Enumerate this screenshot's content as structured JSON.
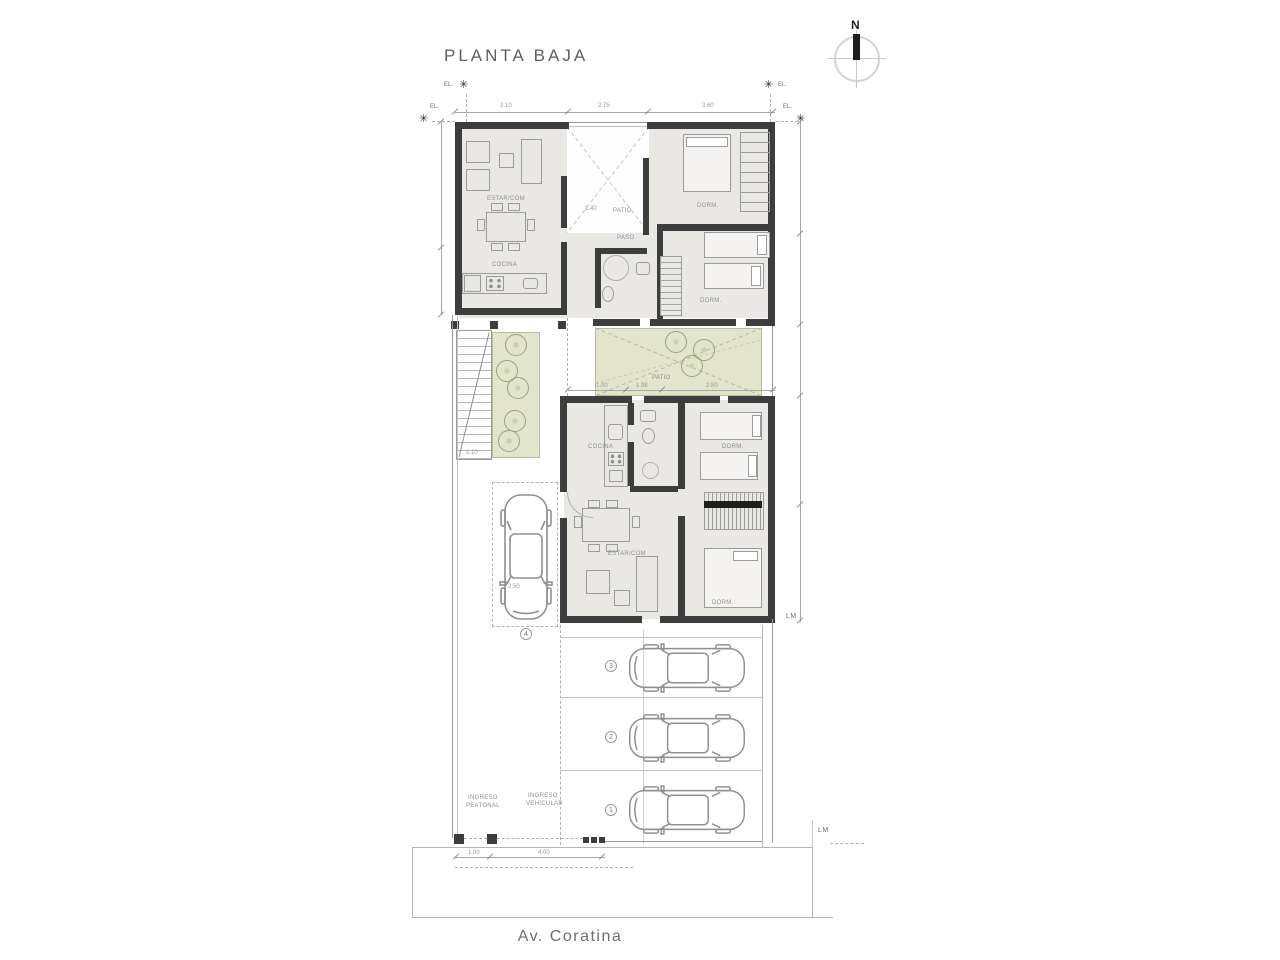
{
  "title": "PLANTA BAJA",
  "compass": {
    "n": "N"
  },
  "street": {
    "name": "Av. Coratina"
  },
  "markers": {
    "el": "EL.",
    "lm": "LM"
  },
  "upper_unit": {
    "estar": "ESTAR/COM",
    "cocina": "COCINA",
    "patio": "PATIO",
    "paso": "PASO",
    "dorm_a": "DORM.",
    "dorm_b": "DORM."
  },
  "lower_unit": {
    "estar": "ESTAR/COM",
    "cocina": "COCINA",
    "dorm_a": "DORM.",
    "dorm_b": "DORM."
  },
  "site": {
    "patio": "PATIO",
    "ingreso_peatonal": [
      "INGRESO",
      "PEATONAL"
    ],
    "ingreso_vehicular": [
      "INGRESO",
      "VEHICULAR"
    ]
  },
  "parking": {
    "spot_1": "1",
    "spot_2": "2",
    "spot_3": "3",
    "spot_4": "4"
  },
  "dimensions": {
    "top_1": "3.10",
    "top_2": "2.75",
    "top_3": "3.60",
    "patio_1": "1.00",
    "patio_2": "1.98",
    "patio_3": "2.80",
    "entry_ped": "1.00",
    "entry_veh": "4.00",
    "stair": "1.10",
    "paso": "1.40",
    "car": "2.50"
  },
  "colors": {
    "wall": "#3d3d3d",
    "floor": "#e9e8e5",
    "green": "#e2e4cc",
    "line": "#9a9a9a",
    "text": "#6a6a6a"
  }
}
